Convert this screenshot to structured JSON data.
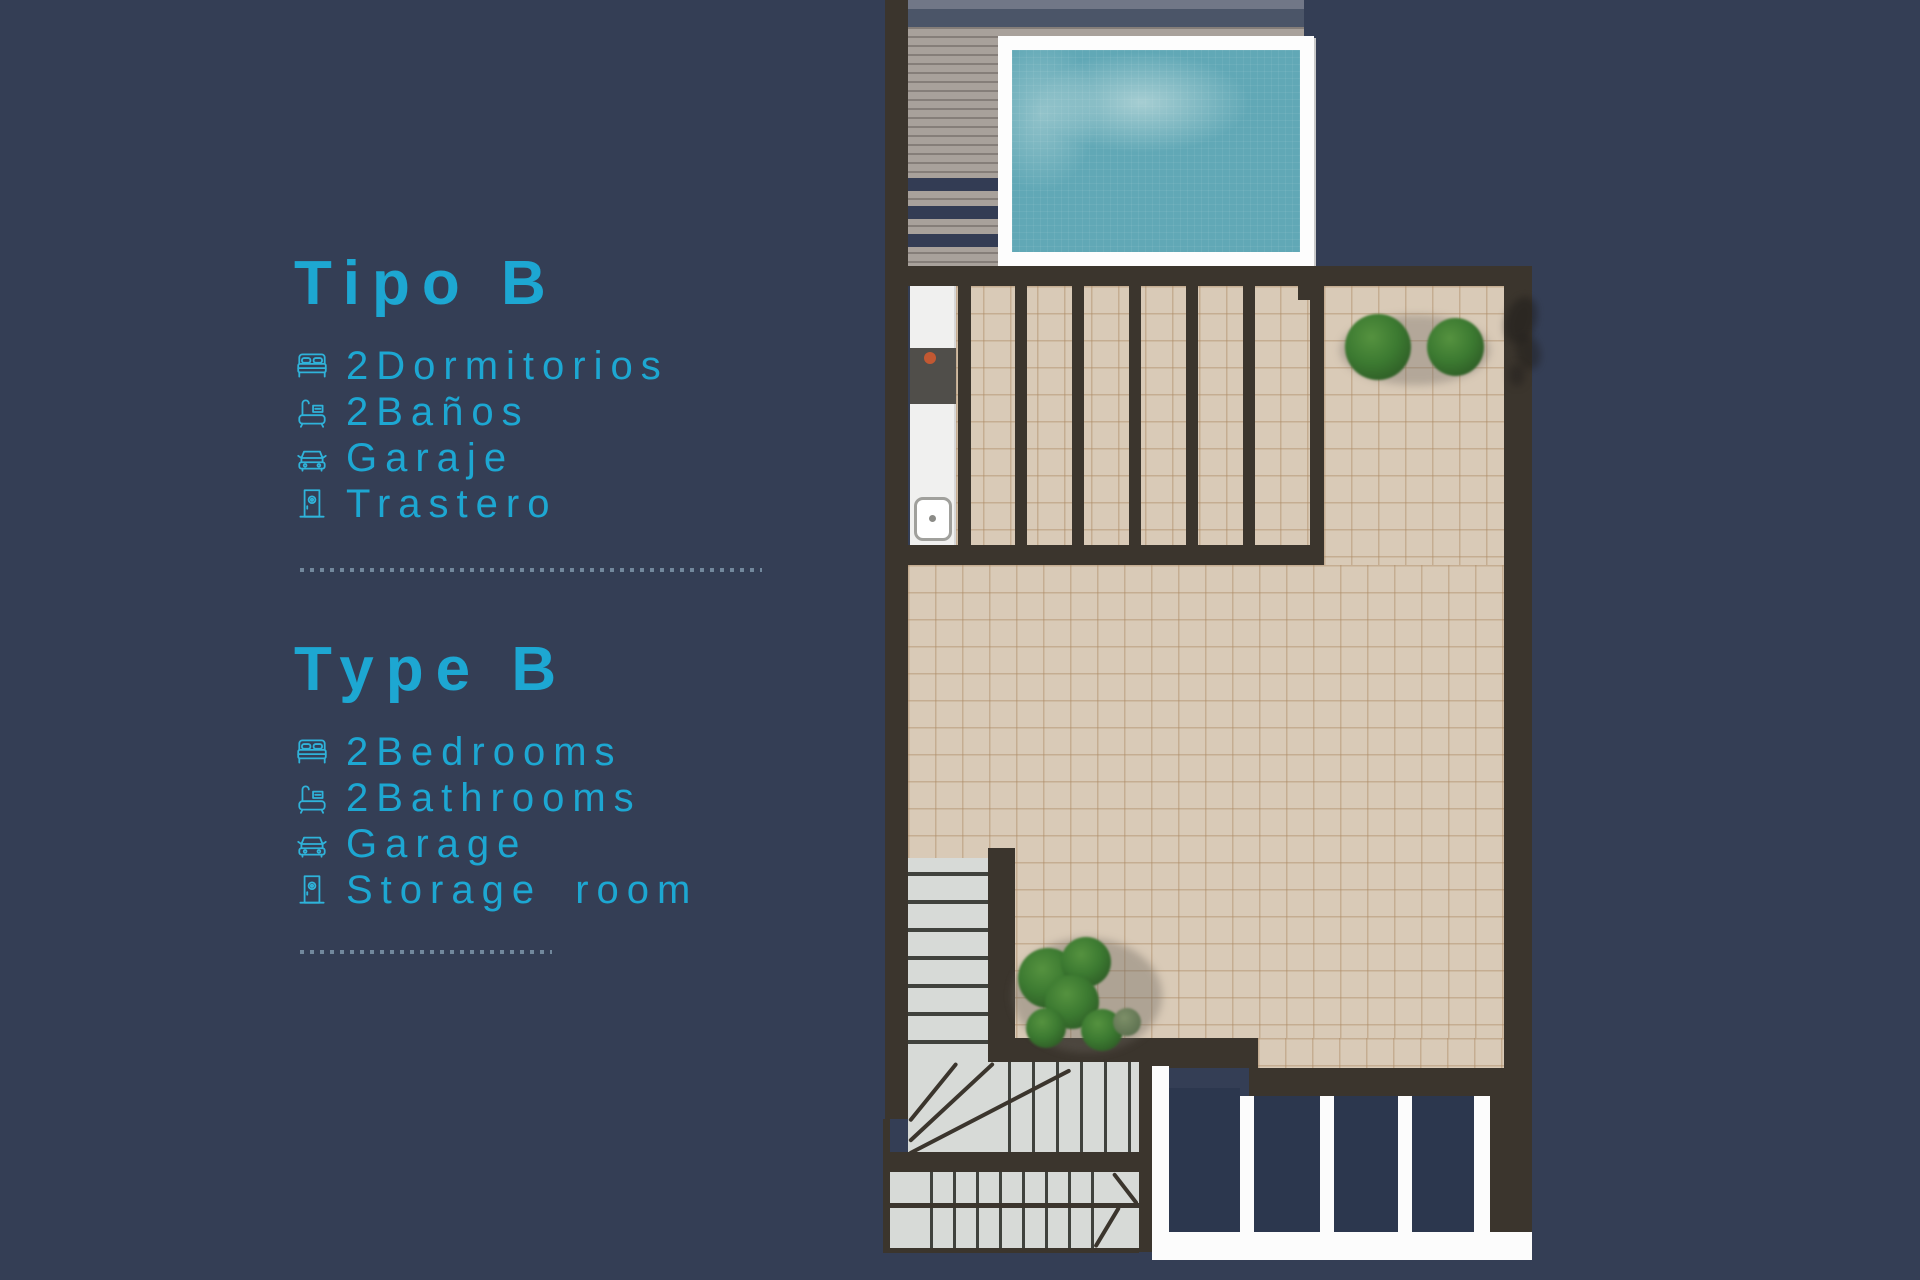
{
  "legend": {
    "es": {
      "title": "Tipo B",
      "items": [
        {
          "icon": "bed-icon",
          "qty": "2",
          "label": "Dormitorios"
        },
        {
          "icon": "bath-icon",
          "qty": "2",
          "label": "Baños"
        },
        {
          "icon": "car-icon",
          "qty": "",
          "label": "Garaje"
        },
        {
          "icon": "door-icon",
          "qty": "",
          "label": "Trastero"
        }
      ]
    },
    "en": {
      "title": "Type B",
      "items": [
        {
          "icon": "bed-icon",
          "qty": "2",
          "label": "Bedrooms"
        },
        {
          "icon": "bath-icon",
          "qty": "2",
          "label": "Bathrooms"
        },
        {
          "icon": "car-icon",
          "qty": "",
          "label": "Garage"
        },
        {
          "icon": "door-icon",
          "qty": "",
          "label": "Storage room"
        }
      ]
    }
  },
  "colors": {
    "background_navy": "#343e55",
    "accent_cyan": "#1da7d2",
    "icon_cyan": "#2fb3da",
    "dotted_separator": "#7d95aa",
    "wall_dark": "#3b352d",
    "terrace_tile": "#d9cab7",
    "pool_water": "#61a8b6",
    "pool_coping_white": "#ffffff",
    "wood_deck": "#a8a19b",
    "stair_gray": "#d7dad7",
    "bush_green": "#3c7a31",
    "cooktop_orange": "#c25832"
  },
  "floorplan": {
    "features": [
      "swimming-pool",
      "wood-deck",
      "deck-steps",
      "rooftop-terrace",
      "pergola-beams",
      "kitchenette-counter",
      "cooktop",
      "sink",
      "planter-bushes",
      "staircase",
      "lower-level-bays"
    ]
  }
}
